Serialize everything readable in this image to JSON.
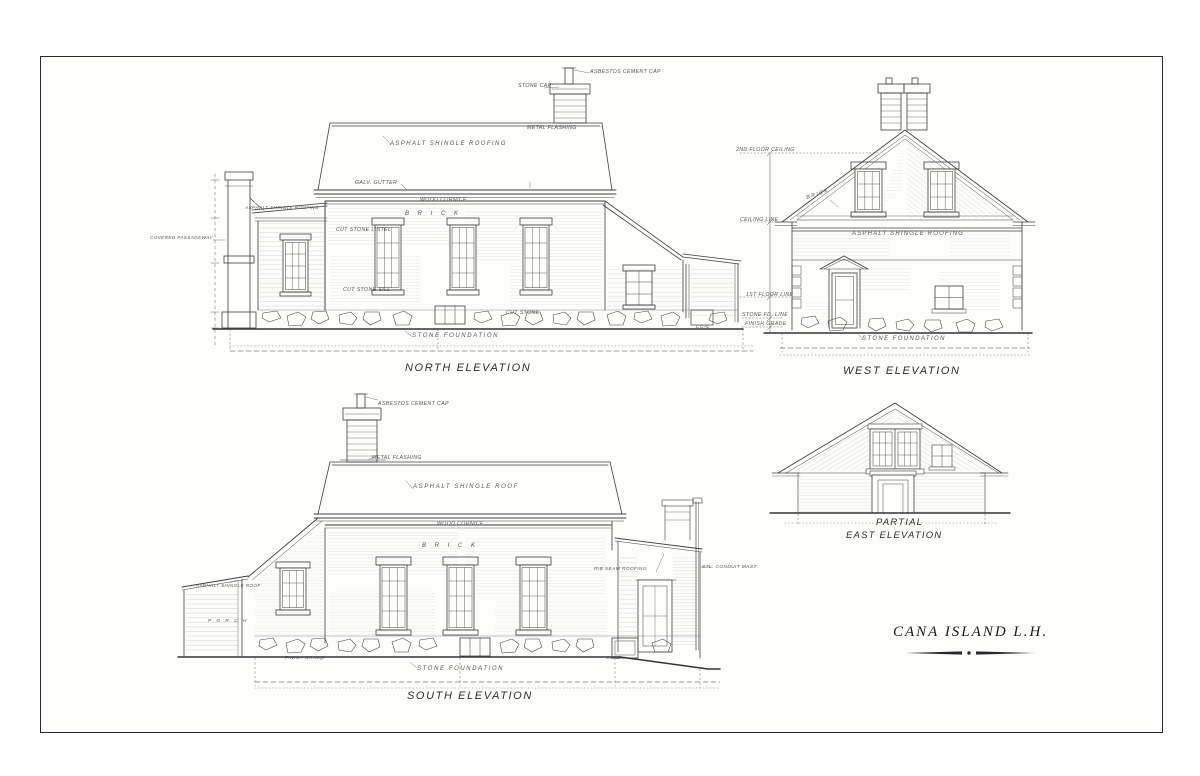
{
  "sheet": {
    "title_block": {
      "title": "CANA ISLAND L.H."
    },
    "levels": {
      "fl2_ceiling": "2ND FLOOR CEILING",
      "ceiling": "CEILING LINE",
      "fl1": "1ST FLOOR LINE",
      "stone_fd": "STONE FD. LINE",
      "grade": "FINISH GRADE"
    },
    "north": {
      "caption": "NORTH ELEVATION",
      "annotations": {
        "vent_cap": "ASBESTOS CEMENT CAP",
        "stone_cap": "STONE CAP",
        "metal_flashing": "METAL FLASHING",
        "roof": "ASPHALT SHINGLE ROOFING",
        "gutter": "GALV. GUTTER",
        "cornice": "WOOD CORNICE",
        "porch_roof": "ASPHALT SHINGLE ROOFING",
        "passage": "COVERED PASSAGEWAY",
        "brick": "B R I C K",
        "lintel": "CUT STONE LINTEL",
        "sill": "CUT STONE SILL",
        "cut_stone": "CUT STONE",
        "foundation": "STONE FOUNDATION",
        "coal": "COAL"
      }
    },
    "west": {
      "caption": "WEST ELEVATION",
      "annotations": {
        "brick": "BRICK",
        "roof": "ASPHALT SHINGLE ROOFING",
        "foundation": "STONE FOUNDATION"
      }
    },
    "south": {
      "caption": "SOUTH ELEVATION",
      "annotations": {
        "vent_cap": "ASBESTOS CEMENT CAP",
        "flashing": "METAL FLASHING",
        "roof": "ASPHALT SHINGLE ROOF",
        "cornice": "WOOD CORNICE",
        "brick": "B R I C K",
        "porch_roof": "ASPHALT SHINGLE ROOF",
        "porch": "P O R C H",
        "grade": "FINISH GRADE",
        "rib_roof": "RIB SEAM ROOFING",
        "mast": "STL. CONDUIT MAST",
        "foundation": "STONE FOUNDATION",
        "coal": "COAL"
      }
    },
    "east": {
      "caption_line1": "PARTIAL",
      "caption_line2": "EAST ELEVATION"
    }
  }
}
